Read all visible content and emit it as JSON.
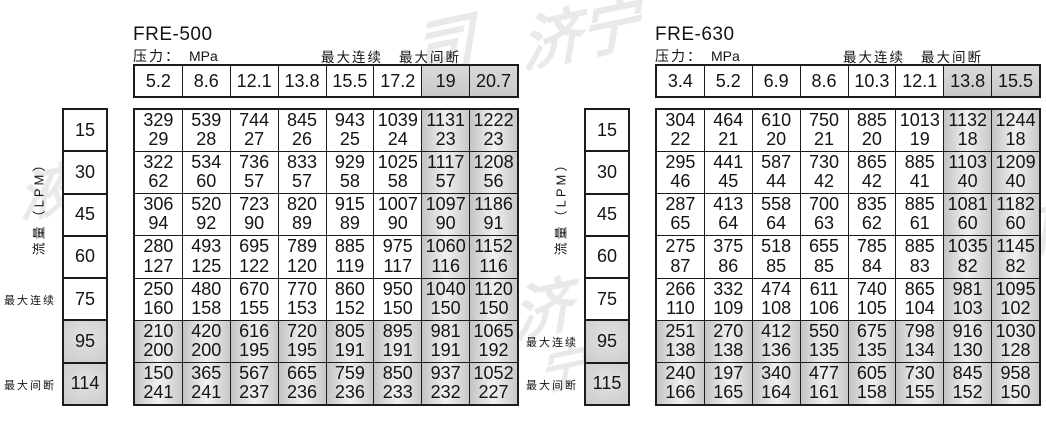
{
  "page": {
    "background": "#ffffff",
    "border_color": "#1c1c1c",
    "shaded_fill": "#d2d2d2",
    "text_color": "#141414"
  },
  "watermark": {
    "color": "#e9e9e9",
    "fragments": [
      {
        "text": "司",
        "x": 412,
        "y": -4,
        "size": 62
      },
      {
        "text": "济宁",
        "x": 520,
        "y": -14,
        "size": 60
      },
      {
        "text": "液",
        "x": 18,
        "y": 148,
        "size": 56
      },
      {
        "text": "济",
        "x": 512,
        "y": 262,
        "size": 60
      },
      {
        "text": "宁",
        "x": 538,
        "y": 330,
        "size": 48
      },
      {
        "text": "司",
        "x": 995,
        "y": 192,
        "size": 54
      }
    ]
  },
  "tables": [
    {
      "model": "FRE-500",
      "pressure_label": "压力：",
      "pressure_unit": "MPa",
      "legend": {
        "continuous": "最大连续",
        "intermittent": "最大间断"
      },
      "flow_axis_label": "流量（LPM）",
      "pressures": [
        "5.2",
        "8.6",
        "12.1",
        "13.8",
        "15.5",
        "17.2",
        "19",
        "20.7"
      ],
      "shaded_columns": [
        6,
        7
      ],
      "rows": [
        {
          "flow": "15",
          "shaded": false,
          "values": [
            [
              "329",
              "29"
            ],
            [
              "539",
              "28"
            ],
            [
              "744",
              "27"
            ],
            [
              "845",
              "26"
            ],
            [
              "943",
              "25"
            ],
            [
              "1039",
              "24"
            ],
            [
              "1131",
              "23"
            ],
            [
              "1222",
              "23"
            ]
          ]
        },
        {
          "flow": "30",
          "shaded": false,
          "values": [
            [
              "322",
              "62"
            ],
            [
              "534",
              "60"
            ],
            [
              "736",
              "57"
            ],
            [
              "833",
              "57"
            ],
            [
              "929",
              "58"
            ],
            [
              "1025",
              "58"
            ],
            [
              "1117",
              "57"
            ],
            [
              "1208",
              "56"
            ]
          ]
        },
        {
          "flow": "45",
          "shaded": false,
          "values": [
            [
              "306",
              "94"
            ],
            [
              "520",
              "92"
            ],
            [
              "723",
              "90"
            ],
            [
              "820",
              "89"
            ],
            [
              "915",
              "89"
            ],
            [
              "1007",
              "90"
            ],
            [
              "1097",
              "90"
            ],
            [
              "1186",
              "91"
            ]
          ]
        },
        {
          "flow": "60",
          "shaded": false,
          "values": [
            [
              "280",
              "127"
            ],
            [
              "493",
              "125"
            ],
            [
              "695",
              "122"
            ],
            [
              "789",
              "120"
            ],
            [
              "885",
              "119"
            ],
            [
              "975",
              "117"
            ],
            [
              "1060",
              "116"
            ],
            [
              "1152",
              "116"
            ]
          ]
        },
        {
          "flow": "75",
          "shaded": false,
          "values": [
            [
              "250",
              "160"
            ],
            [
              "480",
              "158"
            ],
            [
              "670",
              "155"
            ],
            [
              "770",
              "153"
            ],
            [
              "860",
              "152"
            ],
            [
              "950",
              "150"
            ],
            [
              "1040",
              "150"
            ],
            [
              "1120",
              "150"
            ]
          ]
        },
        {
          "flow": "95",
          "shaded": true,
          "values": [
            [
              "210",
              "200"
            ],
            [
              "420",
              "200"
            ],
            [
              "616",
              "195"
            ],
            [
              "720",
              "195"
            ],
            [
              "805",
              "191"
            ],
            [
              "895",
              "191"
            ],
            [
              "981",
              "191"
            ],
            [
              "1065",
              "192"
            ]
          ]
        },
        {
          "flow": "114",
          "shaded": true,
          "values": [
            [
              "150",
              "241"
            ],
            [
              "365",
              "241"
            ],
            [
              "567",
              "237"
            ],
            [
              "665",
              "236"
            ],
            [
              "759",
              "236"
            ],
            [
              "850",
              "233"
            ],
            [
              "937",
              "232"
            ],
            [
              "1052",
              "227"
            ]
          ]
        }
      ],
      "side_labels": [
        {
          "text": "最大连续",
          "row": 4
        },
        {
          "text": "最大间断",
          "row": 6
        }
      ]
    },
    {
      "model": "FRE-630",
      "pressure_label": "压力：",
      "pressure_unit": "MPa",
      "legend": {
        "continuous": "最大连续",
        "intermittent": "最大间断"
      },
      "flow_axis_label": "流量（LPM）",
      "pressures": [
        "3.4",
        "5.2",
        "6.9",
        "8.6",
        "10.3",
        "12.1",
        "13.8",
        "15.5"
      ],
      "shaded_columns": [
        6,
        7
      ],
      "rows": [
        {
          "flow": "15",
          "shaded": false,
          "values": [
            [
              "304",
              "22"
            ],
            [
              "464",
              "21"
            ],
            [
              "610",
              "20"
            ],
            [
              "750",
              "21"
            ],
            [
              "885",
              "20"
            ],
            [
              "1013",
              "19"
            ],
            [
              "1132",
              "18"
            ],
            [
              "1244",
              "18"
            ]
          ]
        },
        {
          "flow": "30",
          "shaded": false,
          "values": [
            [
              "295",
              "46"
            ],
            [
              "441",
              "45"
            ],
            [
              "587",
              "44"
            ],
            [
              "730",
              "42"
            ],
            [
              "865",
              "42"
            ],
            [
              "885",
              "41"
            ],
            [
              "1103",
              "40"
            ],
            [
              "1209",
              "40"
            ]
          ]
        },
        {
          "flow": "45",
          "shaded": false,
          "values": [
            [
              "287",
              "65"
            ],
            [
              "413",
              "64"
            ],
            [
              "558",
              "64"
            ],
            [
              "700",
              "63"
            ],
            [
              "835",
              "62"
            ],
            [
              "885",
              "61"
            ],
            [
              "1081",
              "60"
            ],
            [
              "1182",
              "60"
            ]
          ]
        },
        {
          "flow": "60",
          "shaded": false,
          "values": [
            [
              "275",
              "87"
            ],
            [
              "375",
              "86"
            ],
            [
              "518",
              "85"
            ],
            [
              "655",
              "85"
            ],
            [
              "785",
              "84"
            ],
            [
              "885",
              "83"
            ],
            [
              "1035",
              "82"
            ],
            [
              "1145",
              "82"
            ]
          ]
        },
        {
          "flow": "75",
          "shaded": false,
          "values": [
            [
              "266",
              "110"
            ],
            [
              "332",
              "109"
            ],
            [
              "474",
              "108"
            ],
            [
              "611",
              "106"
            ],
            [
              "740",
              "105"
            ],
            [
              "865",
              "104"
            ],
            [
              "981",
              "103"
            ],
            [
              "1095",
              "102"
            ]
          ]
        },
        {
          "flow": "95",
          "shaded": true,
          "values": [
            [
              "251",
              "138"
            ],
            [
              "270",
              "138"
            ],
            [
              "412",
              "136"
            ],
            [
              "550",
              "135"
            ],
            [
              "675",
              "135"
            ],
            [
              "798",
              "134"
            ],
            [
              "916",
              "130"
            ],
            [
              "1030",
              "128"
            ]
          ]
        },
        {
          "flow": "115",
          "shaded": true,
          "values": [
            [
              "240",
              "166"
            ],
            [
              "197",
              "165"
            ],
            [
              "340",
              "164"
            ],
            [
              "477",
              "161"
            ],
            [
              "605",
              "158"
            ],
            [
              "730",
              "155"
            ],
            [
              "845",
              "152"
            ],
            [
              "958",
              "150"
            ]
          ]
        }
      ],
      "side_labels": [
        {
          "text": "最大连续",
          "row": 5
        },
        {
          "text": "最大间断",
          "row": 6
        }
      ]
    }
  ]
}
